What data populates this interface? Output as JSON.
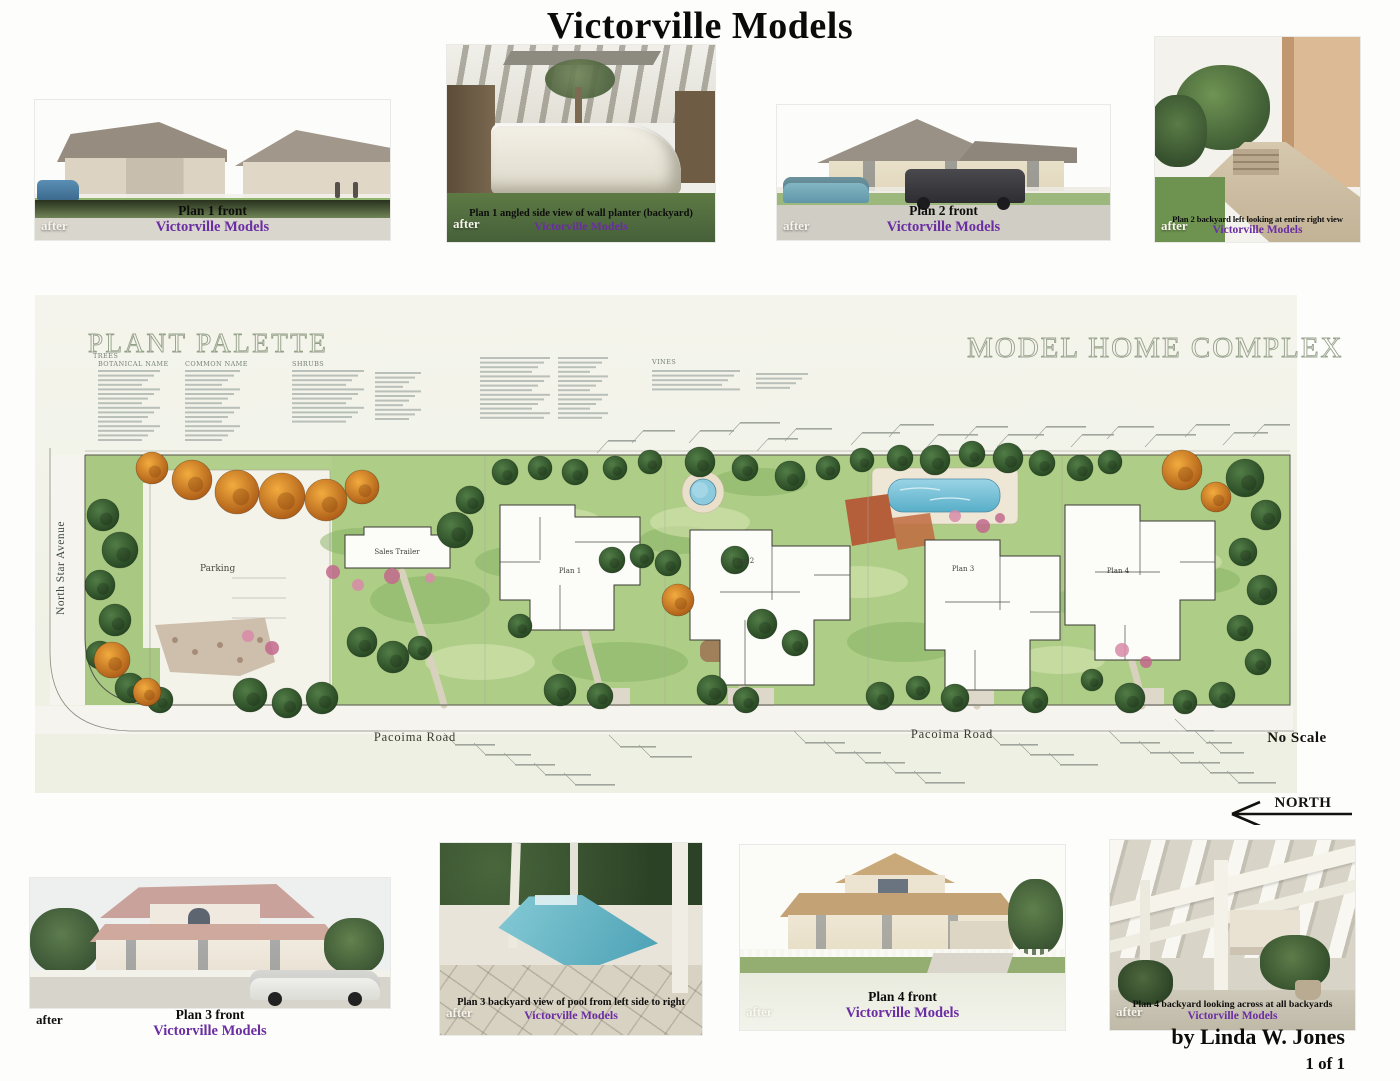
{
  "page": {
    "title": "Victorville Models",
    "author": "by Linda W. Jones",
    "page_number": "1 of 1"
  },
  "colors": {
    "brand_purple": "#6a2da2",
    "header_outline_green": "#95a089",
    "sheet_ivory": "#f3f3ea",
    "lawn_green": "#aecd87",
    "tree_dark_green": "#2f5330",
    "tree_orange": "#d9822a",
    "pool_blue": "#7cc4da"
  },
  "photos": {
    "top": [
      {
        "label": "Plan 1 front",
        "brand": "Victorville Models",
        "tag": "after"
      },
      {
        "label": "Plan 1 angled side view of wall planter (backyard)",
        "brand": "Victorville Models",
        "tag": "after"
      },
      {
        "label": "Plan 2 front",
        "brand": "Victorville Models",
        "tag": "after"
      },
      {
        "label": "Plan 2 backyard left looking at entire right view",
        "brand": "Victorville Models",
        "tag": "after"
      }
    ],
    "bottom": [
      {
        "label": "Plan 3 front",
        "brand": "Victorville Models",
        "tag": "after"
      },
      {
        "label": "Plan 3 backyard view of pool from left side to right",
        "brand": "Victorville Models",
        "tag": "after"
      },
      {
        "label": "Plan 4 front",
        "brand": "Victorville Models",
        "tag": "after"
      },
      {
        "label": "Plan 4 backyard looking across at all backyards",
        "brand": "Victorville Models",
        "tag": "after"
      }
    ]
  },
  "site_plan": {
    "palette_title": "PLANT PALETTE",
    "complex_title": "MODEL HOME COMPLEX",
    "palette_sections": {
      "group": "TREES",
      "botanical": "BOTANICAL NAME",
      "common": "COMMON NAME",
      "shrubs": "SHRUBS",
      "vines": "VINES"
    },
    "labels": {
      "street_left": "North Star Avenue",
      "parking": "Parking",
      "sales_trailer": "Sales Trailer",
      "plan1": "Plan 1",
      "plan2": "Plan 2",
      "plan3": "Plan 3",
      "plan4": "Plan 4",
      "road_left": "Pacoima Road",
      "road_right": "Pacoima Road",
      "no_scale": "No Scale",
      "north": "NORTH"
    }
  }
}
